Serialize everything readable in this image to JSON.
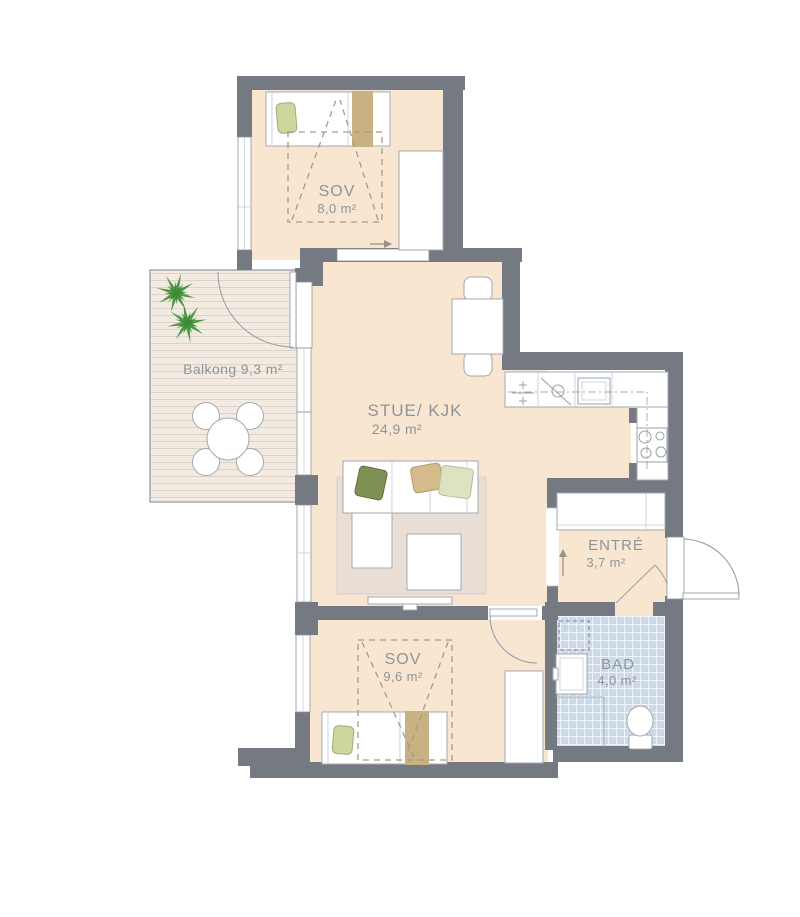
{
  "rooms": {
    "sov_top": {
      "name": "SOV",
      "area": "8,0 m²"
    },
    "balcony": {
      "label": "Balkong 9,3 m²"
    },
    "stue_kjk": {
      "name": "STUE/ KJK",
      "area": "24,9 m²"
    },
    "entre": {
      "name": "ENTRÉ",
      "area": "3,7 m²"
    },
    "bad": {
      "name": "BAD",
      "area": "4,0 m²"
    },
    "sov_bottom": {
      "name": "SOV",
      "area": "9,6 m²"
    }
  },
  "colors": {
    "wall": "#757982",
    "room": "#f8e6d0",
    "deck-bg": "#f3ebe1",
    "deck-line": "#ddd2c5",
    "tile": "#cbdbe9",
    "rug": "#e8ded6",
    "stroke": "#a3a8af",
    "line": "#9aa0a7",
    "text": "#8f949b",
    "tan": "#c8b183",
    "plant": "#4d9b43",
    "plant-dark": "#3f8a39",
    "pillow-green": "#cdd69d",
    "sofa-green": "#7f9054",
    "sofa-tan": "#d5bb8b",
    "sofa-pale": "#dde3c0",
    "arrow": "#98938a",
    "dash": "#a89a88"
  }
}
